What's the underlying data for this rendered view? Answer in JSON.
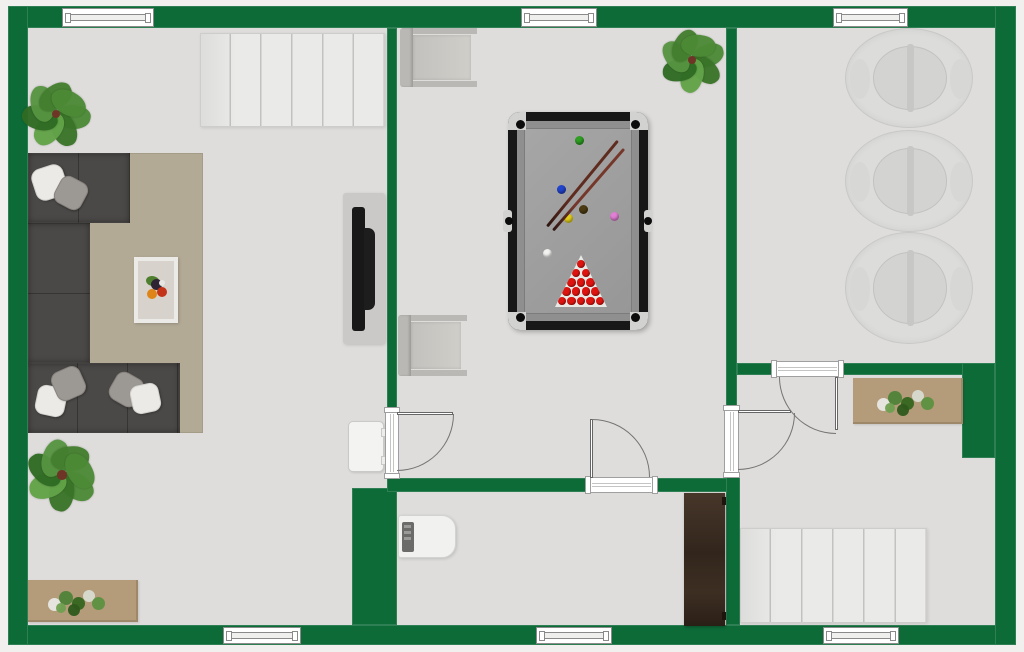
{
  "canvas": {
    "width": 1024,
    "height": 652,
    "background_outside": "#f1f0ee"
  },
  "palette": {
    "wall": "#0d6b38",
    "floor": "#dedddb",
    "stair": "#eaeae8",
    "stair_line": "#c2c2c0",
    "sofa": "#4b4947",
    "rug": "#b3aa96",
    "pillow_white": "#eceae7",
    "pillow_gray": "#9c9893",
    "table_frame": "#eceae6",
    "table_top": "#d7d3cc",
    "tv_panel": "#cac9c7",
    "tv_screen": "#181818",
    "radiator": "#f3f3f1",
    "sideboard": "#b49b79",
    "chair": "#bab8b4",
    "chair_seat": "#cbc9c5",
    "pool_frame": "#171717",
    "pool_felt": "#8f8f8f",
    "pool_inner": "#9e9e9e",
    "pool_metal": "#d2d2d0",
    "pool_red": "#dd1410",
    "rack": "#e9e9e6",
    "round_chair": "#dcdcda",
    "round_inner": "#d3d3d1",
    "round_bar": "#c7c7c5",
    "appliance": "#f1f1ef",
    "appliance_panel": "#6b6b69",
    "wardrobe_dark": "#32261c",
    "wardrobe_light": "#47362a",
    "door_line": "#757575",
    "frame_line": "#9f9f9f",
    "window_line": "#8a8a8a",
    "leaf_greens": [
      "#4c8a36",
      "#3a7429",
      "#63a348",
      "#2f6b23",
      "#579441",
      "#447f2f"
    ],
    "plant_center": "#6e3526",
    "fruit": [
      "#4e7f2e",
      "#2f2433",
      "#de8418",
      "#c33317"
    ]
  },
  "elements": [
    {
      "name": "floor",
      "type": "rect",
      "rect": [
        28,
        28,
        967,
        597
      ],
      "color": "floor"
    },
    {
      "name": "outer-wall-top",
      "type": "wall",
      "rect": [
        8,
        6,
        1008,
        22
      ]
    },
    {
      "name": "outer-wall-bottom",
      "type": "wall",
      "rect": [
        8,
        625,
        1008,
        20
      ]
    },
    {
      "name": "outer-wall-left",
      "type": "wall",
      "rect": [
        8,
        6,
        20,
        639
      ]
    },
    {
      "name": "outer-wall-right",
      "type": "wall",
      "rect": [
        995,
        6,
        21,
        639
      ]
    },
    {
      "name": "wall-living-game",
      "type": "wall",
      "rect": [
        387,
        28,
        10,
        384
      ]
    },
    {
      "name": "wall-chimney-block",
      "type": "wall",
      "rect": [
        352,
        488,
        45,
        137
      ]
    },
    {
      "name": "wall-gameroom-south-left",
      "type": "wall",
      "rect": [
        387,
        478,
        203,
        14
      ]
    },
    {
      "name": "wall-gameroom-south-right",
      "type": "wall",
      "rect": [
        653,
        478,
        87,
        14
      ]
    },
    {
      "name": "wall-game-right-upper",
      "type": "wall",
      "rect": [
        726,
        28,
        11,
        382
      ]
    },
    {
      "name": "wall-right-lower",
      "type": "wall",
      "rect": [
        726,
        475,
        14,
        150
      ]
    },
    {
      "name": "wall-rightroom-south-left",
      "type": "wall",
      "rect": [
        737,
        363,
        38,
        12
      ]
    },
    {
      "name": "wall-rightroom-south-right",
      "type": "wall",
      "rect": [
        841,
        363,
        154,
        12
      ]
    },
    {
      "name": "wall-right-block",
      "type": "wall",
      "rect": [
        962,
        363,
        33,
        95
      ]
    },
    {
      "name": "window-top-left",
      "type": "window",
      "rect": [
        62,
        8,
        92,
        19
      ]
    },
    {
      "name": "window-top-middle",
      "type": "window",
      "rect": [
        521,
        8,
        76,
        19
      ]
    },
    {
      "name": "window-top-right",
      "type": "window",
      "rect": [
        833,
        8,
        75,
        19
      ]
    },
    {
      "name": "window-bottom-left",
      "type": "window",
      "rect": [
        223,
        627,
        78,
        17
      ]
    },
    {
      "name": "window-bottom-middle",
      "type": "window",
      "rect": [
        536,
        627,
        76,
        17
      ]
    },
    {
      "name": "window-bottom-right",
      "type": "window",
      "rect": [
        823,
        627,
        76,
        17
      ]
    },
    {
      "name": "staircase-upper",
      "type": "stairs",
      "rect": [
        200,
        33,
        185,
        94
      ],
      "steps": 6
    },
    {
      "name": "staircase-lower",
      "type": "stairs",
      "rect": [
        740,
        528,
        187,
        95
      ],
      "steps": 6
    },
    {
      "name": "area-rug",
      "type": "rug",
      "rect": [
        88,
        153,
        115,
        280
      ]
    },
    {
      "name": "sofa-arm-top",
      "type": "sofa",
      "rect": [
        28,
        153,
        102,
        70
      ],
      "dir": "h",
      "seam": 51
    },
    {
      "name": "sofa-seat-left",
      "type": "sofa",
      "rect": [
        28,
        223,
        62,
        140
      ],
      "dir": "v",
      "seam": 70
    },
    {
      "name": "sofa-arm-bottom",
      "type": "sofa",
      "rect": [
        28,
        363,
        152,
        70
      ],
      "dir": "h",
      "seam": 50
    },
    {
      "name": "pillow",
      "type": "pillow",
      "rect": [
        33,
        166,
        33,
        33
      ],
      "rot": -18,
      "variant": "w"
    },
    {
      "name": "pillow",
      "type": "pillow",
      "rect": [
        56,
        178,
        30,
        30
      ],
      "rot": 28,
      "variant": "g"
    },
    {
      "name": "pillow",
      "type": "pillow",
      "rect": [
        36,
        386,
        30,
        30
      ],
      "rot": 12,
      "variant": "w"
    },
    {
      "name": "pillow",
      "type": "pillow",
      "rect": [
        53,
        368,
        31,
        31
      ],
      "rot": -24,
      "variant": "g"
    },
    {
      "name": "pillow",
      "type": "pillow",
      "rect": [
        111,
        374,
        31,
        31
      ],
      "rot": 30,
      "variant": "g"
    },
    {
      "name": "pillow",
      "type": "pillow",
      "rect": [
        131,
        384,
        29,
        29
      ],
      "rot": -12,
      "variant": "w"
    },
    {
      "name": "coffee-table",
      "type": "coffeetable",
      "rect": [
        134,
        257,
        44,
        66
      ]
    },
    {
      "name": "tv-unit",
      "type": "tv",
      "rect": [
        343,
        193,
        42,
        151
      ]
    },
    {
      "name": "radiator",
      "type": "radiator",
      "rect": [
        348,
        421,
        36,
        51
      ]
    },
    {
      "name": "sideboard-living",
      "type": "sideboard",
      "rect": [
        28,
        580,
        110,
        42
      ],
      "garden": [
        20,
        8
      ]
    },
    {
      "name": "sideboard-hallway",
      "type": "sideboard",
      "rect": [
        853,
        378,
        110,
        46
      ],
      "garden": [
        24,
        10
      ]
    },
    {
      "name": "potted-plant-living-top",
      "type": "plant",
      "cx": 56,
      "cy": 114,
      "size": 62,
      "rot0": 10
    },
    {
      "name": "potted-plant-living-bottom",
      "type": "plant",
      "cx": 62,
      "cy": 475,
      "size": 66,
      "rot0": 40
    },
    {
      "name": "potted-plant-gameroom",
      "type": "plant",
      "cx": 692,
      "cy": 60,
      "size": 58,
      "rot0": -15
    },
    {
      "name": "armchair-gameroom-top",
      "type": "chair",
      "rect": [
        400,
        28,
        77,
        59
      ]
    },
    {
      "name": "armchair-gameroom-bottom",
      "type": "chair",
      "rect": [
        398,
        315,
        69,
        61
      ]
    },
    {
      "name": "pool-table",
      "type": "pooltable",
      "rect": [
        508,
        112,
        140,
        218
      ],
      "balls": [
        [
          "#2f9e23",
          71,
          28
        ],
        [
          "#2244cc",
          53,
          77
        ],
        [
          "#4c3b12",
          75,
          97
        ],
        [
          "#e3cf1c",
          60,
          106
        ],
        [
          "#e07fd3",
          106,
          104
        ],
        [
          "#f2f2f0",
          39,
          141
        ]
      ],
      "rack": [
        47,
        143,
        52,
        52
      ],
      "cues": [
        [
          39,
          114,
          111,
          -50.5,
          "#5e2b1e"
        ],
        [
          45,
          118,
          108,
          -49,
          "#74372a"
        ]
      ]
    },
    {
      "name": "round-chair",
      "type": "roundchair",
      "rect": [
        845,
        28,
        128,
        100
      ]
    },
    {
      "name": "round-chair",
      "type": "roundchair",
      "rect": [
        845,
        130,
        128,
        102
      ]
    },
    {
      "name": "round-chair",
      "type": "roundchair",
      "rect": [
        845,
        232,
        128,
        112
      ]
    },
    {
      "name": "boiler-appliance",
      "type": "appliance",
      "rect": [
        398,
        515,
        58,
        43
      ]
    },
    {
      "name": "wardrobe",
      "type": "wardrobe",
      "rect": [
        684,
        493,
        41,
        133
      ]
    },
    {
      "name": "door-living-to-gameroom",
      "type": "door",
      "frame": [
        385,
        408,
        14,
        70
      ],
      "leaf": [
        397,
        412,
        56,
        3
      ],
      "arc": [
        397,
        414,
        57,
        57
      ],
      "corner": "br"
    },
    {
      "name": "door-gameroom-to-boilerroom",
      "type": "door",
      "frame": [
        586,
        477,
        71,
        16
      ],
      "leaf": [
        590,
        419,
        3,
        59
      ],
      "arc": [
        592,
        419,
        58,
        58
      ],
      "corner": "tr"
    },
    {
      "name": "door-gameroom-to-hallway",
      "type": "door",
      "frame": [
        724,
        406,
        15,
        71
      ],
      "leaf": [
        738,
        410,
        53,
        3
      ],
      "arc": [
        738,
        413,
        57,
        57
      ],
      "corner": "br"
    },
    {
      "name": "door-rightroom-to-hallway",
      "type": "door",
      "frame": [
        772,
        361,
        71,
        16
      ],
      "leaf": [
        835,
        377,
        3,
        53
      ],
      "arc": [
        779,
        377,
        57,
        57
      ],
      "corner": "bl"
    }
  ]
}
